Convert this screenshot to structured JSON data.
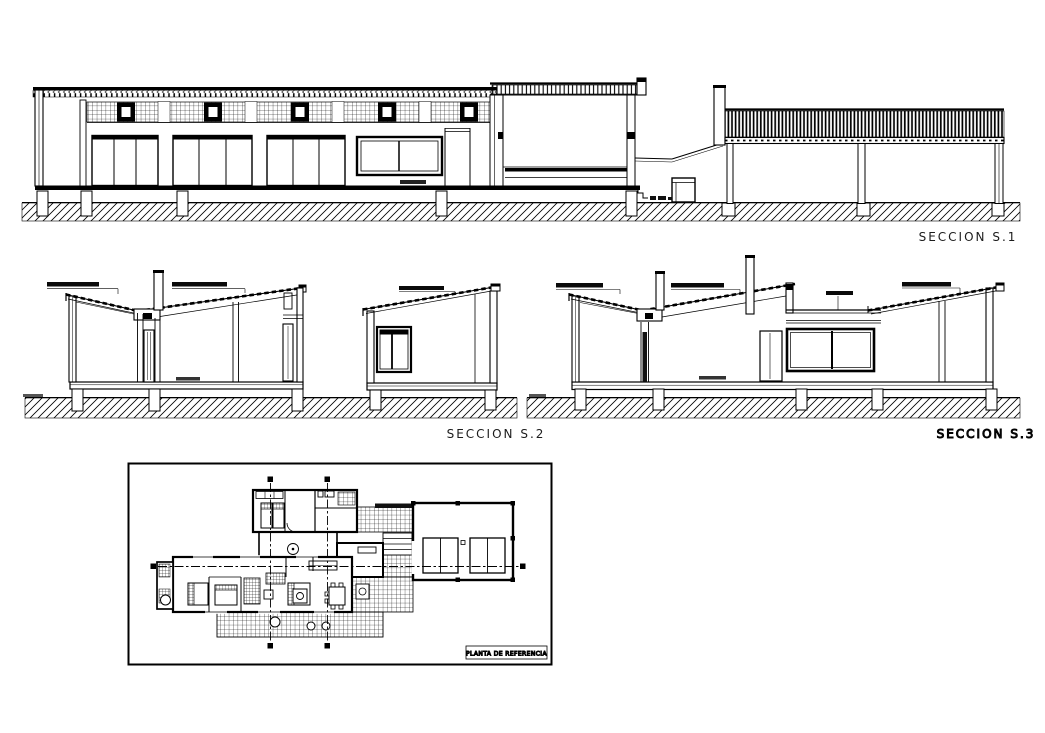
{
  "sheet": {
    "type": "architectural-drawing-sheet",
    "background": "#ffffff",
    "ink": "#000000",
    "label_color": "#1c1c1c",
    "plan_title_color": "#8a8a8a"
  },
  "sections": {
    "s1": {
      "label": "SECCION S.1"
    },
    "s2": {
      "label": "SECCION S.2"
    },
    "s3": {
      "label": "SECCION S.3"
    }
  },
  "plan": {
    "title": "PLANTA DE REFERENCIA"
  }
}
